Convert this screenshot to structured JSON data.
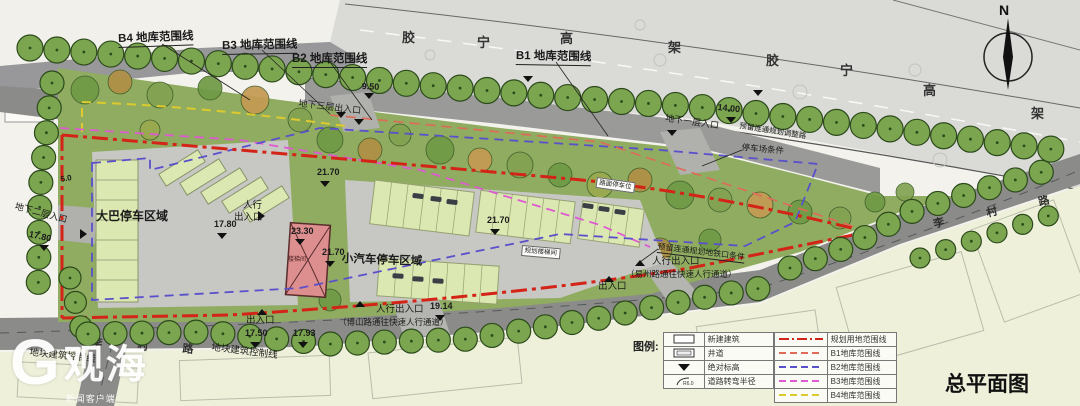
{
  "title": "总平面图",
  "north": {
    "label": "N"
  },
  "watermark": {
    "logo_letter": "G",
    "brand": "观海",
    "sub": "新闻客户端"
  },
  "highway": {
    "name": "胶宁高架",
    "chars": [
      {
        "ch": "胶",
        "x": 402,
        "y": 30
      },
      {
        "ch": "宁",
        "x": 477,
        "y": 35
      },
      {
        "ch": "高",
        "x": 560,
        "y": 31
      },
      {
        "ch": "架",
        "x": 668,
        "y": 40
      },
      {
        "ch": "胶",
        "x": 766,
        "y": 53
      },
      {
        "ch": "宁",
        "x": 840,
        "y": 63
      },
      {
        "ch": "高",
        "x": 923,
        "y": 83
      },
      {
        "ch": "架",
        "x": 1031,
        "y": 106
      }
    ]
  },
  "road_names": {
    "name": "李村路",
    "chars": [
      {
        "ch": "李",
        "x": 932,
        "y": 218,
        "r": -14
      },
      {
        "ch": "村",
        "x": 985,
        "y": 207,
        "r": -14
      },
      {
        "ch": "路",
        "x": 1037,
        "y": 196,
        "r": -14
      },
      {
        "ch": "李",
        "x": 92,
        "y": 336,
        "r": 5
      },
      {
        "ch": "村",
        "x": 138,
        "y": 339,
        "r": 5
      },
      {
        "ch": "路",
        "x": 183,
        "y": 342,
        "r": 5
      }
    ]
  },
  "labels": [
    {
      "n": "label-b4-range",
      "t": "B4 地库范围线",
      "x": 118,
      "y": 34,
      "s": 11.5,
      "b": 1,
      "u": 1,
      "r": -2
    },
    {
      "n": "label-b3-range",
      "t": "B3 地库范围线",
      "x": 222,
      "y": 41,
      "s": 11.5,
      "b": 1,
      "u": 1,
      "r": -1
    },
    {
      "n": "label-b2-range",
      "t": "B2 地库范围线",
      "x": 292,
      "y": 54,
      "s": 11.5,
      "b": 1,
      "u": 1,
      "r": 0
    },
    {
      "n": "label-b1-range",
      "t": "B1 地库范围线",
      "x": 516,
      "y": 51,
      "s": 11.5,
      "b": 1,
      "u": 1,
      "r": 1
    },
    {
      "n": "label-elev-950",
      "t": "9.50",
      "x": 362,
      "y": 82,
      "s": 9,
      "b": 1,
      "r": 3
    },
    {
      "n": "label-entry-basement3",
      "t": "地下三层出入口",
      "x": 299,
      "y": 99,
      "s": 9,
      "r": 7
    },
    {
      "n": "label-elev-1400",
      "t": "14.00",
      "x": 718,
      "y": 103,
      "s": 9,
      "b": 1,
      "r": 6
    },
    {
      "n": "label-entry-basement1",
      "t": "地下一层入口",
      "x": 666,
      "y": 114,
      "s": 9,
      "r": 8
    },
    {
      "n": "label-reserve-road",
      "t": "预留连通规划调整路",
      "x": 740,
      "y": 122,
      "s": 7.5,
      "r": 9
    },
    {
      "n": "label-parking-condition",
      "t": "停车场条件",
      "x": 742,
      "y": 143,
      "s": 8.5,
      "r": 5
    },
    {
      "n": "label-bus-parking-area",
      "t": "大巴停车区域",
      "x": 96,
      "y": 210,
      "s": 12,
      "b": 1
    },
    {
      "n": "label-elev-1780",
      "t": "17.80",
      "x": 214,
      "y": 220,
      "s": 9,
      "b": 1
    },
    {
      "n": "label-ped-entry-1a",
      "t": "人行",
      "x": 243,
      "y": 201,
      "s": 9.5
    },
    {
      "n": "label-ped-entry-1b",
      "t": "出入口",
      "x": 234,
      "y": 213,
      "s": 9.5
    },
    {
      "n": "label-elev-2330",
      "t": "23.30",
      "x": 291,
      "y": 227,
      "s": 9,
      "b": 1
    },
    {
      "n": "label-elev-2170a",
      "t": "21.70",
      "x": 317,
      "y": 168,
      "s": 9,
      "b": 1
    },
    {
      "n": "label-elev-2170b",
      "t": "21.70",
      "x": 322,
      "y": 248,
      "s": 9,
      "b": 1
    },
    {
      "n": "label-elev-2170c",
      "t": "21.70",
      "x": 487,
      "y": 216,
      "s": 9,
      "b": 1
    },
    {
      "n": "label-car-parking-area",
      "t": "小汽车停车区域",
      "x": 342,
      "y": 254,
      "s": 11.5,
      "b": 1,
      "r": 2
    },
    {
      "n": "label-dim-50",
      "t": "5.0",
      "x": 60,
      "y": 176,
      "s": 8,
      "b": 1,
      "r": -10
    },
    {
      "n": "label-entry-basement2",
      "t": "地下二层入口",
      "x": 16,
      "y": 202,
      "s": 9,
      "r": 15
    },
    {
      "n": "label-elev-1780b",
      "t": "17.80",
      "x": 30,
      "y": 230,
      "s": 9,
      "b": 1,
      "r": 12
    },
    {
      "n": "label-exit-mid",
      "t": "出入口",
      "x": 598,
      "y": 282,
      "s": 9.5
    },
    {
      "n": "label-ped-entry-2",
      "t": "人行出入口",
      "x": 652,
      "y": 257,
      "s": 9.5
    },
    {
      "n": "label-ped-note-2",
      "t": "（易州路通往快速人行通道）",
      "x": 626,
      "y": 270,
      "s": 8.5
    },
    {
      "n": "label-reserve-metro",
      "t": "预留连通规划地铁口条件",
      "x": 658,
      "y": 243,
      "s": 8,
      "r": 7,
      "u": 1
    },
    {
      "n": "label-exit-left",
      "t": "出入口",
      "x": 246,
      "y": 316,
      "s": 9.5
    },
    {
      "n": "label-ped-entry-3",
      "t": "人行出入口",
      "x": 376,
      "y": 305,
      "s": 9.5
    },
    {
      "n": "label-elev-1914",
      "t": "19.14",
      "x": 430,
      "y": 302,
      "s": 9,
      "b": 1
    },
    {
      "n": "label-ped-note-3",
      "t": "（博山路通往快速人行通道）",
      "x": 338,
      "y": 318,
      "s": 8.5
    },
    {
      "n": "label-elev-1750",
      "t": "17.50",
      "x": 245,
      "y": 329,
      "s": 9,
      "b": 1
    },
    {
      "n": "label-elev-1793",
      "t": "17.93",
      "x": 293,
      "y": 329,
      "s": 9,
      "b": 1
    },
    {
      "n": "label-building-control-1",
      "t": "地块建筑控制线",
      "x": 212,
      "y": 343,
      "s": 9.5,
      "r": 7
    },
    {
      "n": "label-building-control-2",
      "t": "地块建筑控制线",
      "x": 30,
      "y": 348,
      "s": 9.5,
      "r": 6
    },
    {
      "n": "label-stair",
      "t": "楼梯间",
      "x": 288,
      "y": 257,
      "s": 6,
      "c": "#4a1f1f"
    },
    {
      "n": "label-surface-parking",
      "t": "路面停车位",
      "x": 597,
      "y": 177,
      "s": 6.5,
      "box": 1,
      "r": 8
    },
    {
      "n": "label-plan-stair",
      "t": "规划楼梯间",
      "x": 522,
      "y": 245,
      "s": 6.5,
      "box": 1,
      "r": 5
    }
  ],
  "markers": [
    {
      "type": "down",
      "x": 369,
      "y": 93
    },
    {
      "type": "down",
      "x": 341,
      "y": 112
    },
    {
      "type": "down",
      "x": 359,
      "y": 119
    },
    {
      "type": "down",
      "x": 528,
      "y": 76
    },
    {
      "type": "down",
      "x": 758,
      "y": 90
    },
    {
      "type": "down",
      "x": 731,
      "y": 117
    },
    {
      "type": "down",
      "x": 672,
      "y": 130
    },
    {
      "type": "down",
      "x": 222,
      "y": 233
    },
    {
      "type": "down",
      "x": 300,
      "y": 239
    },
    {
      "type": "down",
      "x": 325,
      "y": 181
    },
    {
      "type": "down",
      "x": 330,
      "y": 261
    },
    {
      "type": "down",
      "x": 495,
      "y": 229
    },
    {
      "type": "down",
      "x": 44,
      "y": 245
    },
    {
      "type": "down",
      "x": 255,
      "y": 342
    },
    {
      "type": "down",
      "x": 303,
      "y": 342
    },
    {
      "type": "down",
      "x": 440,
      "y": 315
    },
    {
      "type": "up",
      "x": 609,
      "y": 276
    },
    {
      "type": "up",
      "x": 262,
      "y": 309
    },
    {
      "type": "up",
      "x": 360,
      "y": 301
    },
    {
      "type": "up",
      "x": 640,
      "y": 260
    },
    {
      "type": "right",
      "x": 258,
      "y": 216
    },
    {
      "type": "right",
      "x": 80,
      "y": 234
    }
  ],
  "leaders": [
    [
      162,
      44,
      250,
      100
    ],
    [
      262,
      50,
      330,
      114
    ],
    [
      330,
      62,
      372,
      120
    ],
    [
      556,
      62,
      608,
      136
    ],
    [
      742,
      150,
      702,
      166
    ],
    [
      658,
      249,
      640,
      262
    ]
  ],
  "legend": {
    "title": "图例:",
    "symbol_items": [
      {
        "symbol": "new-building-rect",
        "label": "新建建筑"
      },
      {
        "symbol": "shaft-rect",
        "label": "井道"
      },
      {
        "symbol": "triangle-down",
        "label": "绝对标高"
      },
      {
        "symbol": "turn-radius",
        "label": "道路转弯半径",
        "note": "R6.0"
      }
    ],
    "line_items": [
      {
        "style": "dashdot",
        "color": "#d42418",
        "label": "规划用地范围线"
      },
      {
        "style": "dashed",
        "color": "#e06a5a",
        "label": "B1地库范围线"
      },
      {
        "style": "dashed",
        "color": "#5a50cc",
        "label": "B2地库范围线"
      },
      {
        "style": "dashed",
        "color": "#de5ad2",
        "label": "B3地库范围线"
      },
      {
        "style": "dashed",
        "color": "#ddca2e",
        "label": "B4地库范围线"
      }
    ]
  },
  "colors": {
    "boundary_red": "#d42418",
    "b1_line": "#e06a5a",
    "b2_line": "#5a50cc",
    "b3_line": "#de5ad2",
    "b4_line": "#ddca2e",
    "site_green": "#8fac60",
    "street_tree": "#7ba54e",
    "road_gray": "#8b8b89",
    "highway_gray": "#dadad7",
    "parking_gray": "#c7c7c3",
    "stall_green": "#dce8b2",
    "building_red": "#dd8f8f",
    "paper": "#f4f2ec",
    "block_pale": "#eef0da"
  }
}
